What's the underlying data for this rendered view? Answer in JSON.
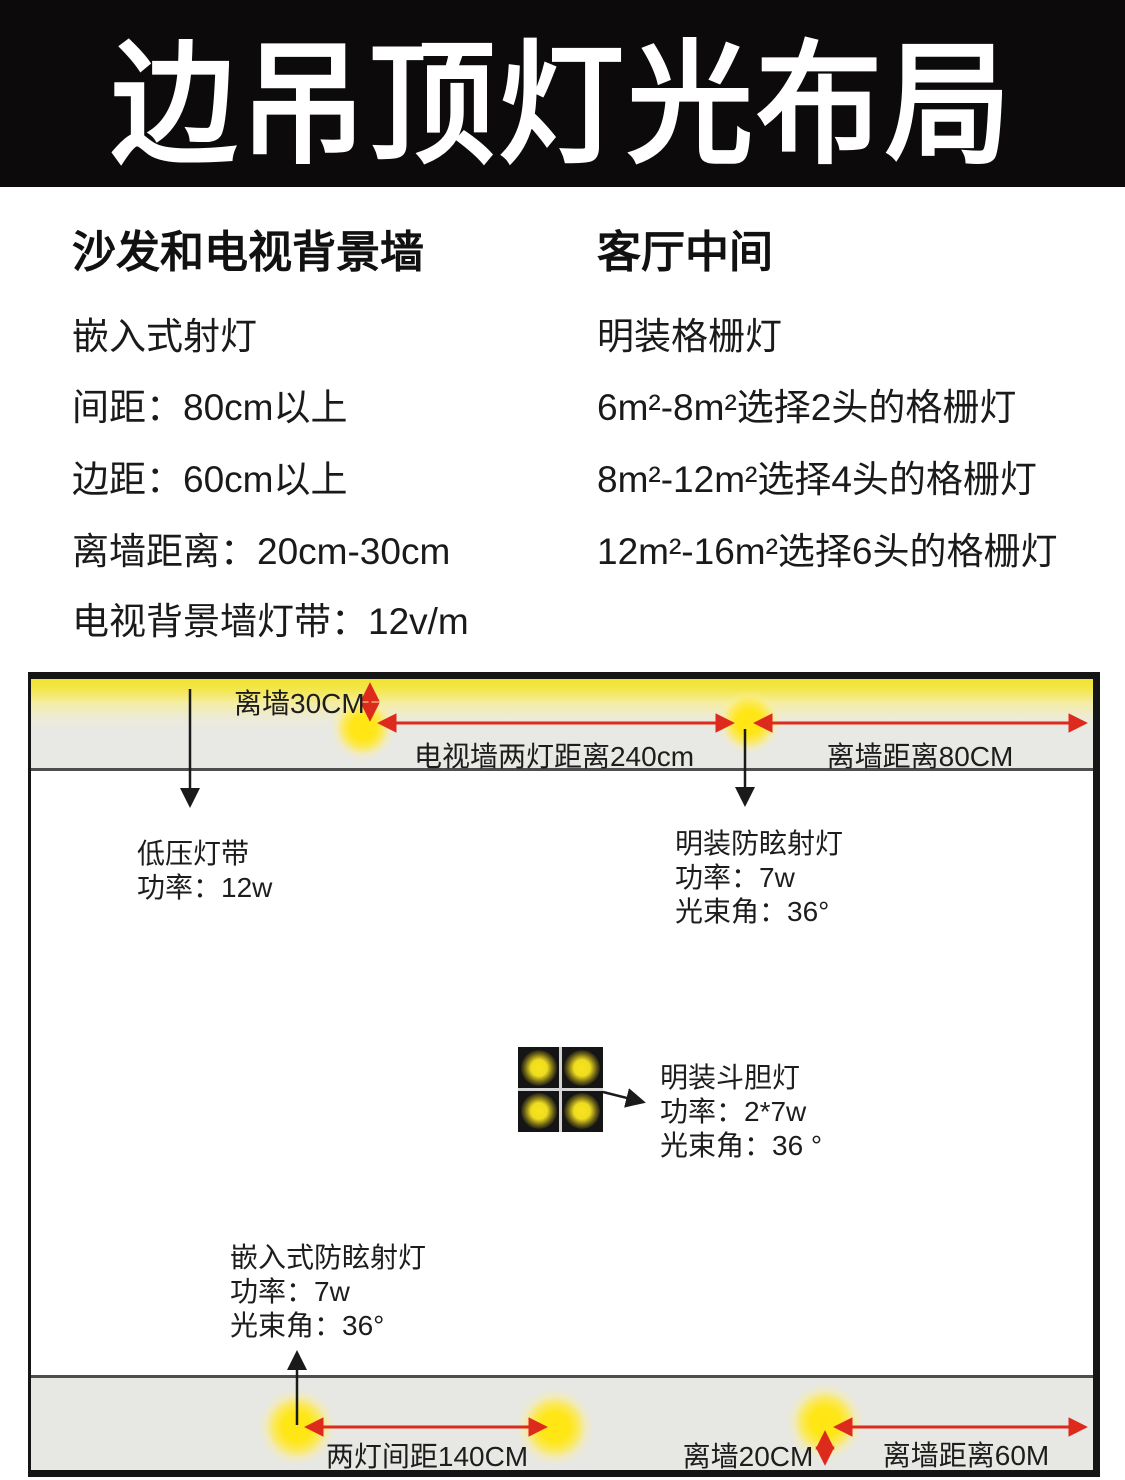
{
  "header": {
    "title": "边吊顶灯光布局"
  },
  "sections": {
    "left": {
      "heading": "沙发和电视背景墙",
      "lines": [
        "嵌入式射灯",
        "间距：80cm以上",
        "边距：60cm以上",
        "离墙距离：20cm-30cm",
        "电视背景墙灯带：12v/m"
      ]
    },
    "right": {
      "heading": "客厅中间",
      "lines": [
        "明装格栅灯",
        "6m²-8m²选择2头的格栅灯",
        "8m²-12m²选择4头的格栅灯",
        "12m²-16m²选择6头的格栅灯"
      ]
    }
  },
  "diagram": {
    "top_labels": {
      "wall_offset": "离墙30CM",
      "tv_wall_spacing": "电视墙两灯距离240cm",
      "wall_distance": "离墙距离80CM"
    },
    "bottom_labels": {
      "spacing": "两灯间距140CM",
      "wall_offset": "离墙20CM",
      "wall_distance": "离墙距离60M"
    },
    "annotations": {
      "led_strip": [
        "低压灯带",
        "功率：12w"
      ],
      "surface_spotlight": [
        "明装防眩射灯",
        "功率：7w",
        "光束角：36°"
      ],
      "double_head_light": [
        "明装斗胆灯",
        "功率：2*7w",
        "光束角：36 °"
      ],
      "recessed_spotlight": [
        "嵌入式防眩射灯",
        "功率：7w",
        "光束角：36°"
      ]
    },
    "colors": {
      "accent_red": "#dd2a1c",
      "light_glow_yellow": "#ffe616",
      "strip_yellow": "#f1e32f",
      "ceiling_gray": "#e8e8e5",
      "fixture_black": "#151515"
    }
  }
}
